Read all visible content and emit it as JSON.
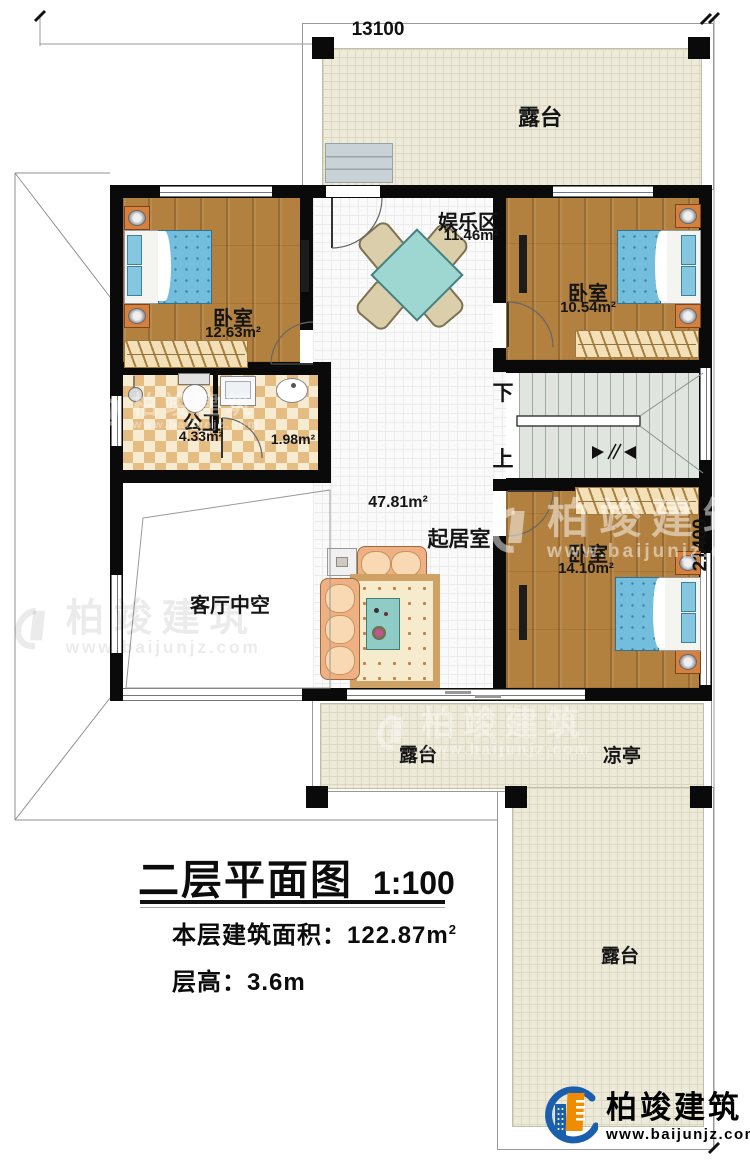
{
  "dimensions": {
    "top": "13100",
    "right": "21400"
  },
  "rooms": {
    "terrace_top": {
      "label": "露台"
    },
    "bedroom_tl": {
      "name": "卧室",
      "area": "12.63m²"
    },
    "entertainment": {
      "name": "娱乐区",
      "area": "11.46m²"
    },
    "bedroom_tr": {
      "name": "卧室",
      "area": "10.54m²"
    },
    "bathroom": {
      "name": "公卫",
      "area": "4.33m²",
      "area2": "1.98m²"
    },
    "living": {
      "name": "起居室",
      "area": "47.81m²"
    },
    "void": {
      "label": "客厅中空"
    },
    "bedroom_br": {
      "name": "卧室",
      "area": "14.10m²"
    },
    "terrace_bottom": {
      "label": "露台"
    },
    "pavilion": {
      "label": "凉亭"
    },
    "terrace_right": {
      "label": "露台"
    }
  },
  "stairs": {
    "down": "下",
    "up": "上"
  },
  "titleblock": {
    "title": "二层平面图",
    "scale": "1:100",
    "area_label": "本层建筑面积：",
    "area_value": "122.87m",
    "area_sup": "2",
    "height_label": "层高：",
    "height_value": "3.6m"
  },
  "brand": {
    "name": "柏竣建筑",
    "url": "www.baijunjz.com"
  },
  "colors": {
    "wall": "#0a0a0a",
    "terrace": "#edead9",
    "wood": "#b2813f",
    "tile": "#fafafa",
    "stairs": "#e0e5e0",
    "bed": "#74bedd",
    "table_teal": "#9ed6d2",
    "logo_blue": "#1a5fae",
    "logo_orange": "#f08c00"
  }
}
